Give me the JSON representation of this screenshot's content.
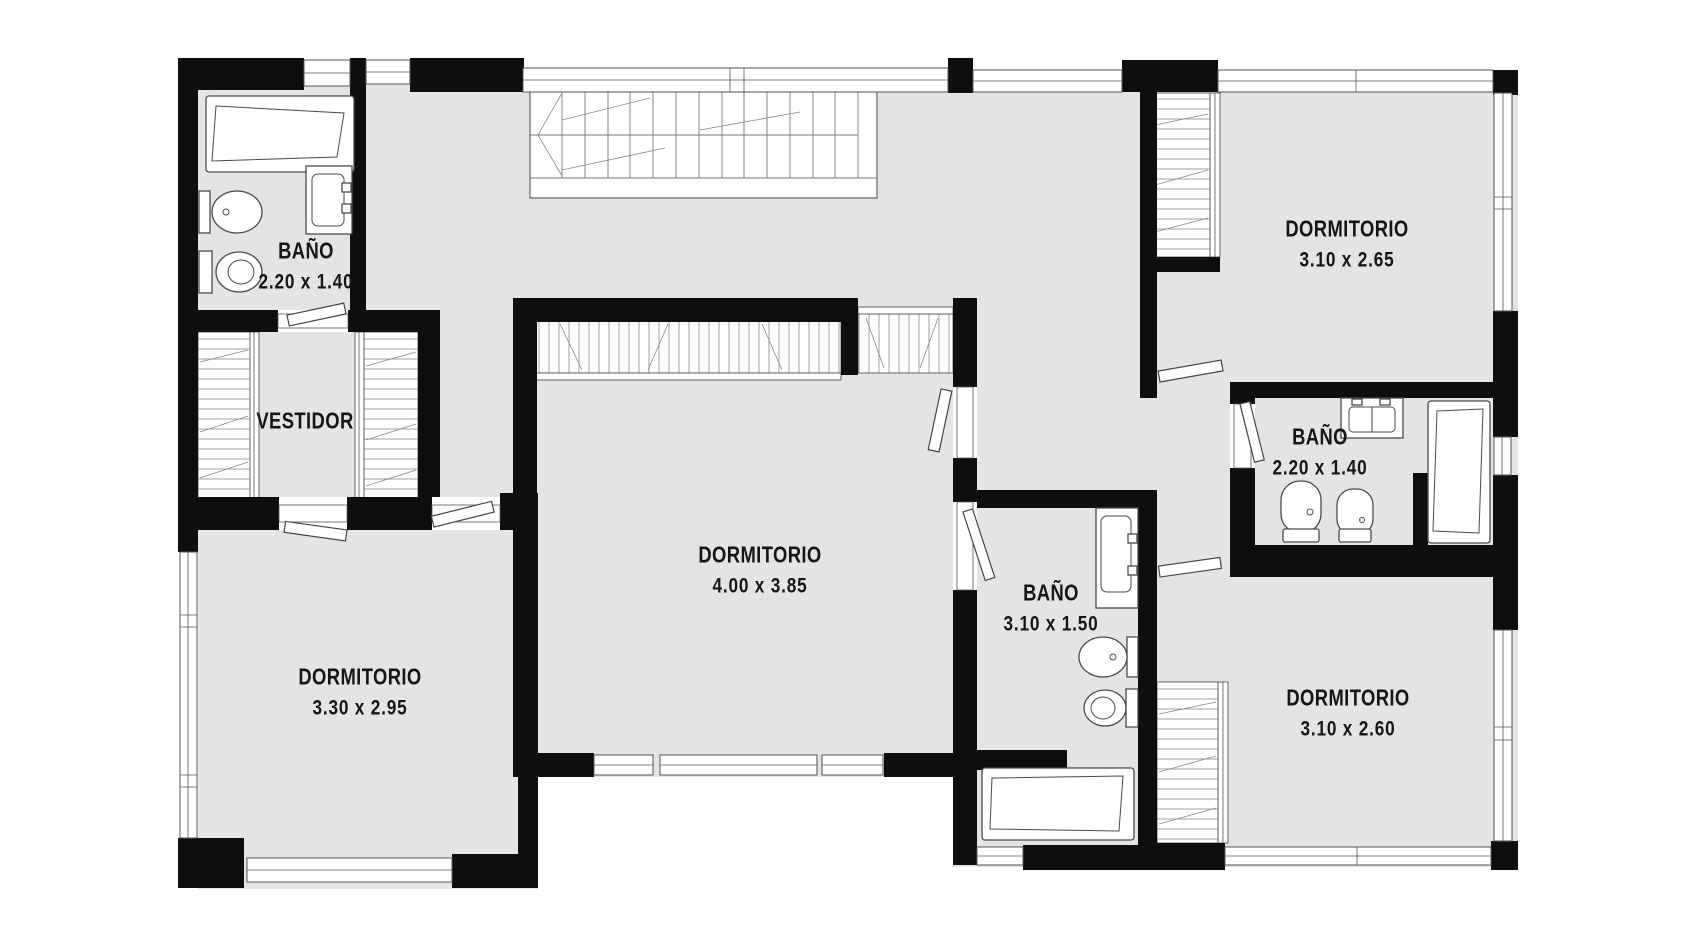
{
  "plan": {
    "language": "es",
    "rooms": [
      {
        "name": "BAÑO",
        "dims": "2.20 x 1.40"
      },
      {
        "name": "VESTIDOR",
        "dims": ""
      },
      {
        "name": "DORMITORIO",
        "dims": "3.30 x 2.95"
      },
      {
        "name": "DORMITORIO",
        "dims": "4.00 x 3.85"
      },
      {
        "name": "BAÑO",
        "dims": "3.10 x 1.50"
      },
      {
        "name": "DORMITORIO",
        "dims": "3.10 x 2.65"
      },
      {
        "name": "BAÑO",
        "dims": "2.20 x 1.40"
      },
      {
        "name": "DORMITORIO",
        "dims": "3.10 x 2.60"
      }
    ],
    "colors": {
      "floor": "#e4e4e4",
      "wall": "#0e0e0e",
      "outline": "#4a4a4a",
      "background": "#ffffff",
      "text": "#161616"
    },
    "fixture_names": [
      "bathtub",
      "toilet",
      "bidet",
      "sink-vanity",
      "staircase",
      "wardrobe",
      "closet",
      "window",
      "door"
    ]
  }
}
